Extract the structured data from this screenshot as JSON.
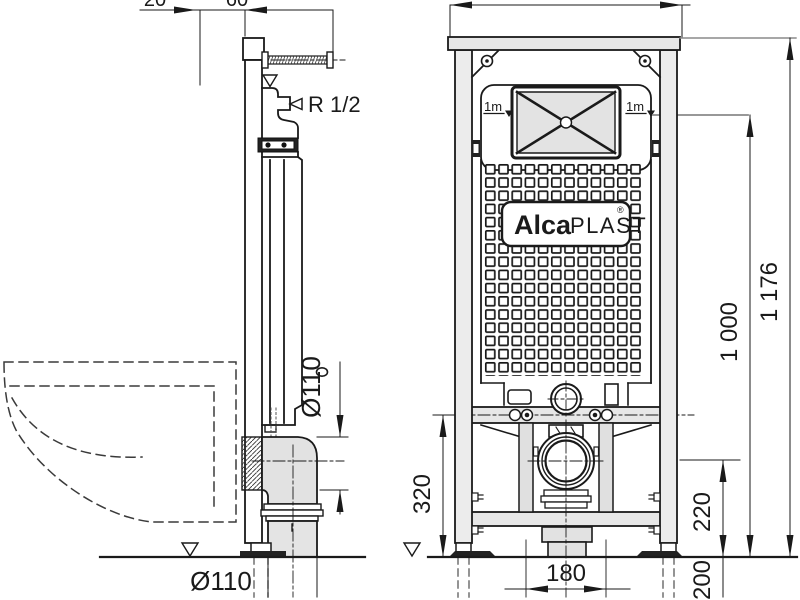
{
  "drawing": {
    "title": "concealed-wc-frame-technical-drawing",
    "brand": {
      "alca": "Alca",
      "plast": "PLAST",
      "reg": "®"
    },
    "labels": {
      "water_inlet": "R 1/2",
      "meter_mark_left": "1m",
      "meter_mark_right": "1m",
      "pipe_dia_side": "Ø110",
      "pipe_dia_bottom": "Ø110"
    },
    "dims": {
      "top_partial_a": "20",
      "top_partial_b": "60",
      "total_height": "1 176",
      "height_1000": "1 000",
      "rail_height": "320",
      "drain_height": "220",
      "below_floor": "200",
      "stud_spacing": "180"
    },
    "colors": {
      "line": "#1a1a1a",
      "fill_gray": "#e7e7e7",
      "fill_light": "#ededed",
      "dim_gray": "#8a8a8a",
      "background": "#ffffff"
    }
  }
}
